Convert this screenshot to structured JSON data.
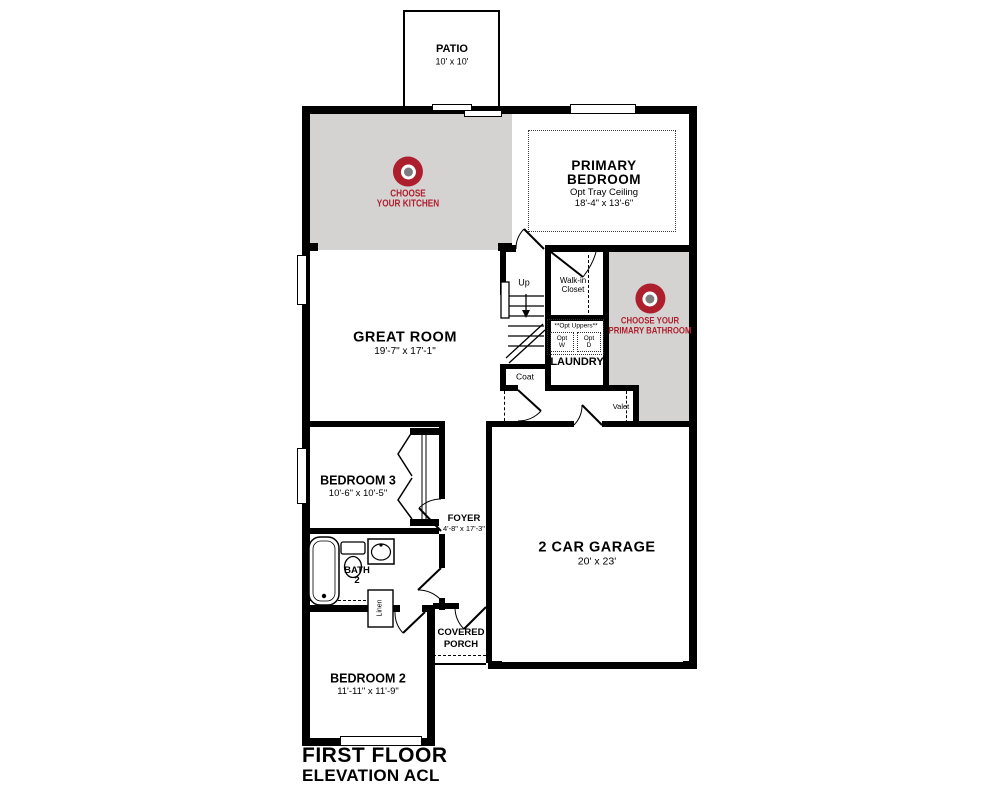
{
  "colors": {
    "wall": "#000000",
    "room_gray": "#d5d3d1",
    "brand_red": "#ae1f2d",
    "logo_gray": "#7d7d7d"
  },
  "title": {
    "line1": "FIRST FLOOR",
    "line2": "ELEVATION ACL"
  },
  "rooms": {
    "patio": {
      "name": "PATIO",
      "dims": "10' x 10'"
    },
    "kitchen": {
      "cta_line1": "CHOOSE",
      "cta_line2": "YOUR KITCHEN"
    },
    "primary_bedroom": {
      "line1": "PRIMARY",
      "line2": "BEDROOM",
      "opt": "Opt Tray Ceiling",
      "dims": "18'-4\" x 13'-6\""
    },
    "great_room": {
      "name": "GREAT ROOM",
      "dims": "19'-7\" x 17'-1\""
    },
    "stairs": {
      "up": "Up"
    },
    "walk_in_closet": {
      "line1": "Walk-in",
      "line2": "Closet"
    },
    "primary_bathroom": {
      "cta_line1": "CHOOSE YOUR",
      "cta_line2": "PRIMARY BATHROOM"
    },
    "laundry": {
      "name": "LAUNDRY",
      "opt_uppers": "**Opt Uppers**",
      "washer_line1": "Opt",
      "washer_line2": "W",
      "dryer_line1": "Opt",
      "dryer_line2": "D"
    },
    "coat": {
      "name": "Coat"
    },
    "valet": {
      "name": "Valet"
    },
    "bedroom_3": {
      "name": "BEDROOM 3",
      "dims": "10'-6\" x 10'-5\""
    },
    "foyer": {
      "name": "FOYER",
      "dims": "4'-8\" x 17'-3\""
    },
    "bath_2": {
      "line1": "BATH",
      "line2": "2"
    },
    "linen": {
      "name": "Linen"
    },
    "garage": {
      "name": "2 CAR GARAGE",
      "dims": "20' x 23'"
    },
    "covered_porch": {
      "line1": "COVERED",
      "line2": "PORCH"
    },
    "bedroom_2": {
      "name": "BEDROOM 2",
      "dims": "11'-11\" x 11'-9\""
    }
  }
}
